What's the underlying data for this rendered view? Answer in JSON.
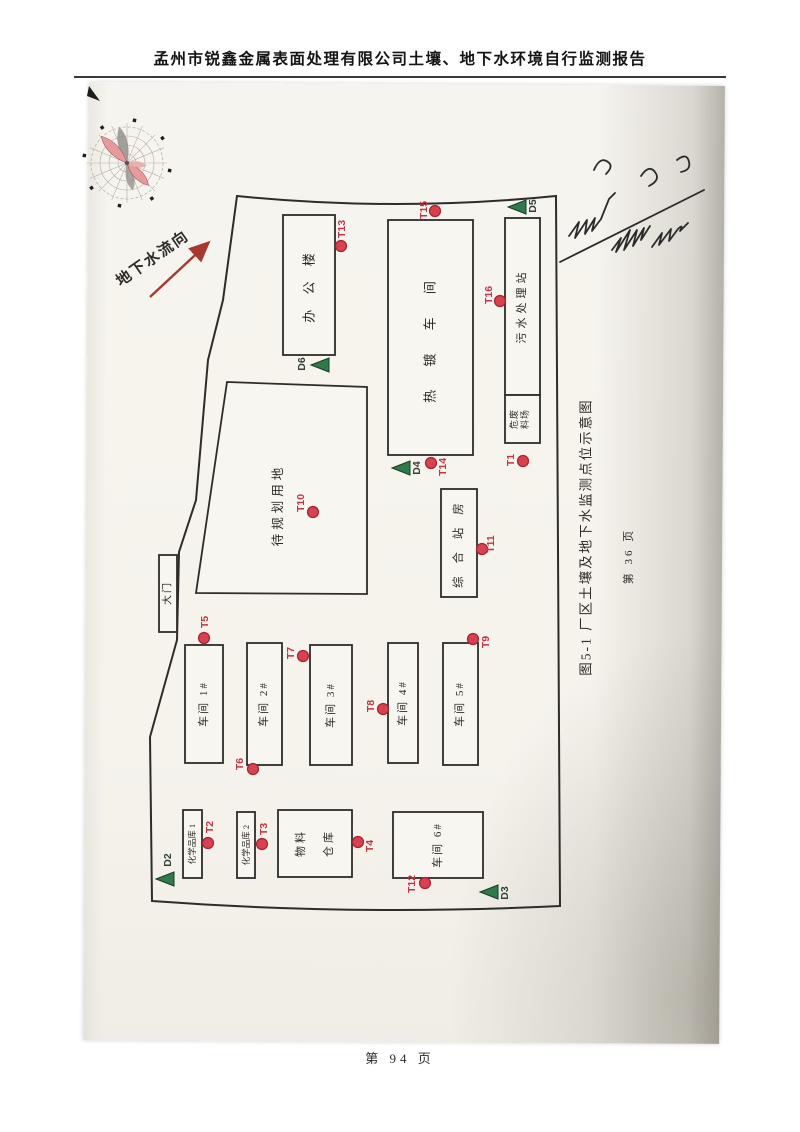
{
  "header": {
    "title": "孟州市锐鑫金属表面处理有限公司土壤、地下水环境自行监测报告"
  },
  "footer": {
    "page_label": "第 94 页"
  },
  "map": {
    "flow_label": "地下水流向",
    "caption": "图5-1 厂区土壤及地下水监测点位示意图",
    "caption_page": "第 36 页",
    "buildings": {
      "office": "办 公 楼",
      "plating": "热 镀 车 间",
      "sewage": "污水处理站",
      "hazwaste_line1": "危废",
      "hazwaste_line2": "料场",
      "planned": "待规划用地",
      "station": "综 合 站 房",
      "gate": "大门",
      "ws1": "车间 1#",
      "ws2": "车间 2#",
      "ws3": "车间 3#",
      "ws4": "车间 4#",
      "ws5": "车间 5#",
      "ws6": "车间 6#",
      "chem1": "化学品库 1",
      "chem2": "化学品库 2",
      "material_line1": "物料",
      "material_line2": "仓库"
    },
    "points": {
      "t1": "T1",
      "t2": "T2",
      "t3": "T3",
      "t4": "T4",
      "t5": "T5",
      "t6": "T6",
      "t7": "T7",
      "t8": "T8",
      "t9": "T9",
      "t10": "T10",
      "t11": "T11",
      "t12": "T12",
      "t13": "T13",
      "t14": "T14",
      "t15": "T15",
      "t16": "T16"
    },
    "wells": {
      "d2": "D2",
      "d3": "D3",
      "d4": "D4",
      "d5": "D5",
      "d6": "D6"
    },
    "colors": {
      "point_red": "#d8414f",
      "point_red_edge": "#a6232f",
      "well_green": "#2e7a4b",
      "well_green_edge": "#163c23",
      "flow_red": "#a73a30"
    }
  }
}
